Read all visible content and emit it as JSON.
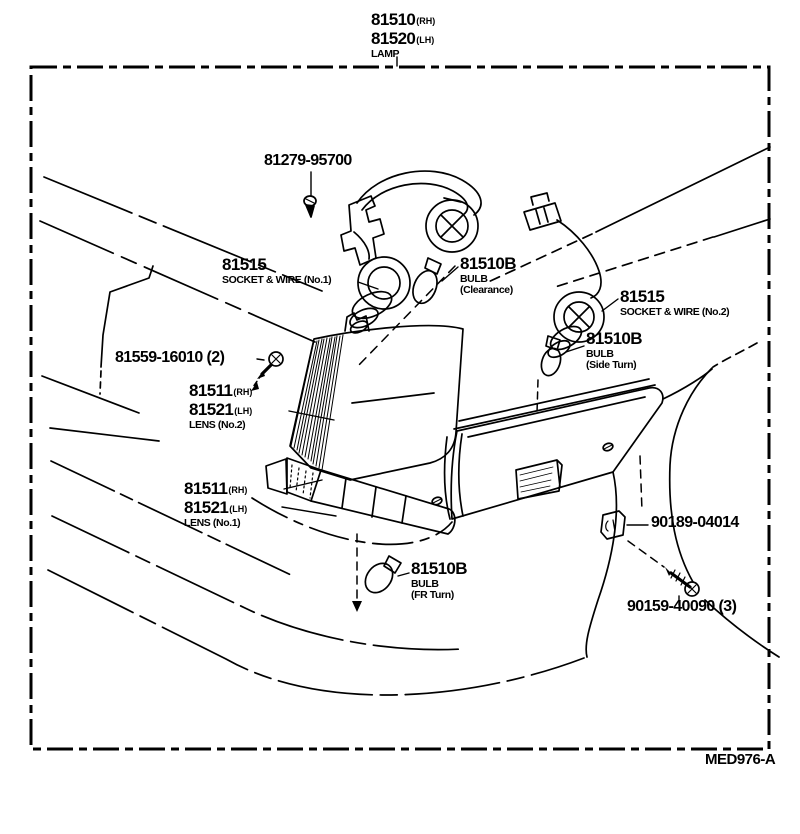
{
  "header": {
    "part_rh": "81510",
    "part_rh_suffix": "(RH)",
    "part_lh": "81520",
    "part_lh_suffix": "(LH)",
    "desc": "LAMP"
  },
  "labels": {
    "retainer": {
      "num": "81279-95700"
    },
    "socket_wire_1": {
      "num": "81515",
      "desc": "SOCKET & WIRE (No.1)"
    },
    "bulb_clearance": {
      "num": "81510B",
      "desc1": "BULB",
      "desc2": "(Clearance)"
    },
    "socket_wire_2": {
      "num": "81515",
      "desc": "SOCKET & WIRE (No.2)"
    },
    "bulb_side_turn": {
      "num": "81510B",
      "desc1": "BULB",
      "desc2": "(Side Turn)"
    },
    "lens_screw": {
      "num": "81559-16010 (2)"
    },
    "lens_no2": {
      "num_rh": "81511",
      "rh": "(RH)",
      "num_lh": "81521",
      "lh": "(LH)",
      "desc": "LENS (No.2)"
    },
    "lens_no1": {
      "num_rh": "81511",
      "rh": "(RH)",
      "num_lh": "81521",
      "lh": "(LH)",
      "desc": "LENS (No.1)"
    },
    "bulb_fr_turn": {
      "num": "81510B",
      "desc1": "BULB",
      "desc2": "(FR Turn)"
    },
    "clip": {
      "num": "90189-04014"
    },
    "garnish_screw": {
      "num": "90159-40090 (3)"
    }
  },
  "footer": {
    "figure_code": "MED976-A"
  },
  "colors": {
    "ink": "#000000",
    "paper": "#ffffff"
  }
}
